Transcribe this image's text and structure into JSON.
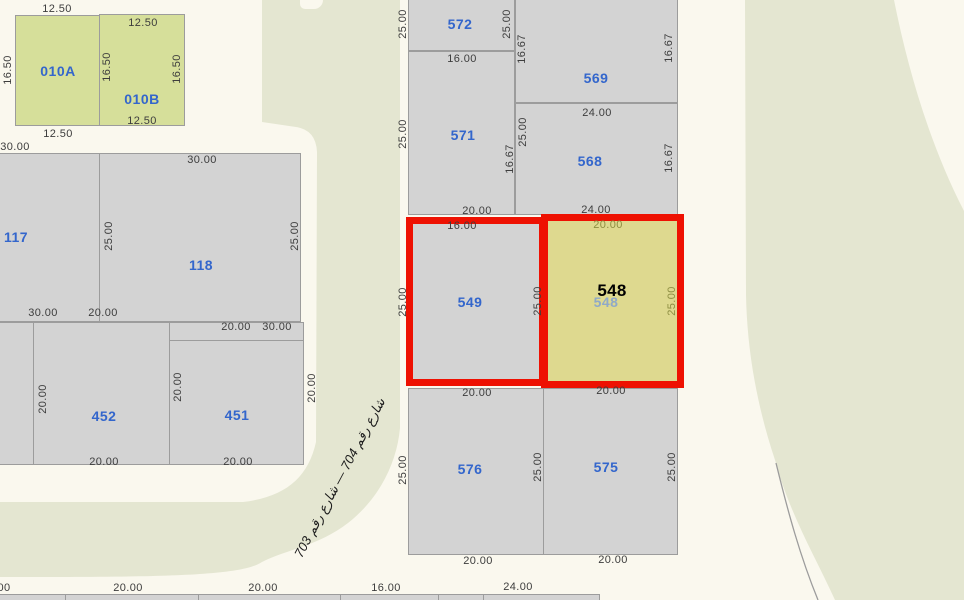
{
  "colors": {
    "background": "#faf8ee",
    "road_green": "#e4e6d1",
    "parcel_gray": "#d3d3d3",
    "parcel_green": "#d6df9a",
    "highlight_yellow": "#ded98f",
    "highlight_red": "#ee1102",
    "parcel_label_blue": "#3366cc",
    "dimension_text": "#3d3d3d",
    "boundary_gray": "#9c9c9c"
  },
  "road": {
    "name_label": "شارع رقم 704 — شارع رقم 703"
  },
  "selected_parcel": {
    "number": "548"
  },
  "parcels": [
    {
      "id": "010A",
      "x": 15,
      "y": 15,
      "w": 85,
      "h": 111,
      "fill": "green"
    },
    {
      "id": "010B",
      "x": 99,
      "y": 14,
      "w": 86,
      "h": 112,
      "fill": "green"
    },
    {
      "id": "117",
      "x": -8,
      "y": 153,
      "w": 108,
      "h": 169,
      "fill": "gray"
    },
    {
      "id": "118",
      "x": 99,
      "y": 153,
      "w": 202,
      "h": 169,
      "fill": "gray"
    },
    {
      "id": "left-sliver",
      "x": -8,
      "y": 322,
      "w": 42,
      "h": 143,
      "fill": "gray"
    },
    {
      "id": "452",
      "x": 33,
      "y": 322,
      "w": 137,
      "h": 143,
      "fill": "gray"
    },
    {
      "id": "451",
      "x": 169,
      "y": 322,
      "w": 135,
      "h": 143,
      "fill": "gray"
    },
    {
      "id": "572",
      "x": 408,
      "y": -2,
      "w": 107,
      "h": 53,
      "fill": "gray"
    },
    {
      "id": "571",
      "x": 408,
      "y": 51,
      "w": 107,
      "h": 164,
      "fill": "gray"
    },
    {
      "id": "569",
      "x": 515,
      "y": -2,
      "w": 163,
      "h": 105,
      "fill": "gray"
    },
    {
      "id": "568",
      "x": 515,
      "y": 103,
      "w": 163,
      "h": 112,
      "fill": "gray"
    },
    {
      "id": "576",
      "x": 408,
      "y": 388,
      "w": 136,
      "h": 167,
      "fill": "gray"
    },
    {
      "id": "575",
      "x": 543,
      "y": 388,
      "w": 135,
      "h": 167,
      "fill": "gray"
    },
    {
      "id": "bottom-strip",
      "x": -2,
      "y": 594,
      "w": 602,
      "h": 10,
      "fill": "gray"
    },
    {
      "id": "549",
      "x": 406,
      "y": 217,
      "w": 140,
      "h": 169,
      "fill": "gray",
      "highlight": true
    },
    {
      "id": "548",
      "x": 541,
      "y": 214,
      "w": 143,
      "h": 174,
      "fill": "yellow",
      "highlight": true
    }
  ],
  "lines": [
    {
      "x": 169,
      "y": 340,
      "w": 135,
      "h": 1
    },
    {
      "x": 65,
      "y": 594,
      "w": 1,
      "h": 7
    },
    {
      "x": 198,
      "y": 594,
      "w": 1,
      "h": 7
    },
    {
      "x": 340,
      "y": 594,
      "w": 1,
      "h": 7
    },
    {
      "x": 438,
      "y": 594,
      "w": 1,
      "h": 7
    },
    {
      "x": 483,
      "y": 594,
      "w": 1,
      "h": 7
    }
  ],
  "labels": [
    {
      "t": "12.50",
      "x": 57,
      "y": 9,
      "cls": "dim"
    },
    {
      "t": "12.50",
      "x": 143,
      "y": 23,
      "cls": "dim"
    },
    {
      "t": "16.50",
      "x": 8,
      "y": 70,
      "cls": "dim",
      "r": -90
    },
    {
      "t": "16.50",
      "x": 107,
      "y": 67,
      "cls": "dim",
      "r": -90
    },
    {
      "t": "16.50",
      "x": 177,
      "y": 69,
      "cls": "dim",
      "r": -90
    },
    {
      "t": "12.50",
      "x": 142,
      "y": 121,
      "cls": "dim"
    },
    {
      "t": "12.50",
      "x": 58,
      "y": 134,
      "cls": "dim"
    },
    {
      "t": "010A",
      "x": 58,
      "y": 71,
      "cls": "parcel-no",
      "name": "parcel-label-010A"
    },
    {
      "t": "010B",
      "x": 142,
      "y": 99,
      "cls": "parcel-no",
      "name": "parcel-label-010B"
    },
    {
      "t": "30.00",
      "x": 15,
      "y": 147,
      "cls": "dim"
    },
    {
      "t": "30.00",
      "x": 202,
      "y": 160,
      "cls": "dim"
    },
    {
      "t": "25.00",
      "x": 109,
      "y": 236,
      "cls": "dim",
      "r": -90
    },
    {
      "t": "25.00",
      "x": 295,
      "y": 236,
      "cls": "dim",
      "r": -90
    },
    {
      "t": "117",
      "x": 16,
      "y": 237,
      "cls": "parcel-no",
      "name": "parcel-label-117"
    },
    {
      "t": "118",
      "x": 201,
      "y": 265,
      "cls": "parcel-no",
      "name": "parcel-label-118"
    },
    {
      "t": "30.00",
      "x": 43,
      "y": 313,
      "cls": "dim"
    },
    {
      "t": "20.00",
      "x": 103,
      "y": 313,
      "cls": "dim"
    },
    {
      "t": "20.00",
      "x": 236,
      "y": 327,
      "cls": "dim"
    },
    {
      "t": "30.00",
      "x": 277,
      "y": 327,
      "cls": "dim"
    },
    {
      "t": "20.00",
      "x": 43,
      "y": 399,
      "cls": "dim",
      "r": -90
    },
    {
      "t": "20.00",
      "x": 178,
      "y": 387,
      "cls": "dim",
      "r": -90
    },
    {
      "t": "20.00",
      "x": 312,
      "y": 388,
      "cls": "dim",
      "r": -90
    },
    {
      "t": "452",
      "x": 104,
      "y": 416,
      "cls": "parcel-no",
      "name": "parcel-label-452"
    },
    {
      "t": "451",
      "x": 237,
      "y": 415,
      "cls": "parcel-no",
      "name": "parcel-label-451"
    },
    {
      "t": "20.00",
      "x": 104,
      "y": 462,
      "cls": "dim"
    },
    {
      "t": "20.00",
      "x": 238,
      "y": 462,
      "cls": "dim"
    },
    {
      "t": "25.00",
      "x": 403,
      "y": 24,
      "cls": "dim",
      "r": -90
    },
    {
      "t": "572",
      "x": 460,
      "y": 24,
      "cls": "parcel-no",
      "name": "parcel-label-572"
    },
    {
      "t": "25.00",
      "x": 507,
      "y": 24,
      "cls": "dim",
      "r": -90
    },
    {
      "t": "16.00",
      "x": 462,
      "y": 59,
      "cls": "dim"
    },
    {
      "t": "16.67",
      "x": 522,
      "y": 49,
      "cls": "dim",
      "r": -90
    },
    {
      "t": "569",
      "x": 596,
      "y": 78,
      "cls": "parcel-no",
      "name": "parcel-label-569"
    },
    {
      "t": "16.67",
      "x": 669,
      "y": 48,
      "cls": "dim",
      "r": -90
    },
    {
      "t": "25.00",
      "x": 403,
      "y": 134,
      "cls": "dim",
      "r": -90
    },
    {
      "t": "571",
      "x": 463,
      "y": 135,
      "cls": "parcel-no",
      "name": "parcel-label-571"
    },
    {
      "t": "16.67",
      "x": 510,
      "y": 159,
      "cls": "dim",
      "r": -90
    },
    {
      "t": "24.00",
      "x": 597,
      "y": 113,
      "cls": "dim"
    },
    {
      "t": "25.00",
      "x": 523,
      "y": 132,
      "cls": "dim",
      "r": -90
    },
    {
      "t": "568",
      "x": 590,
      "y": 161,
      "cls": "parcel-no",
      "name": "parcel-label-568"
    },
    {
      "t": "16.67",
      "x": 669,
      "y": 158,
      "cls": "dim",
      "r": -90
    },
    {
      "t": "20.00",
      "x": 477,
      "y": 211,
      "cls": "dim"
    },
    {
      "t": "24.00",
      "x": 596,
      "y": 210,
      "cls": "dim"
    },
    {
      "t": "16.00",
      "x": 462,
      "y": 226,
      "cls": "dim"
    },
    {
      "t": "20.00",
      "x": 608,
      "y": 225,
      "cls": "dim-olive"
    },
    {
      "t": "25.00",
      "x": 403,
      "y": 302,
      "cls": "dim",
      "r": -90
    },
    {
      "t": "549",
      "x": 470,
      "y": 302,
      "cls": "parcel-no",
      "name": "parcel-label-549"
    },
    {
      "t": "25.00",
      "x": 538,
      "y": 301,
      "cls": "dim",
      "r": -90
    },
    {
      "t": "548",
      "x": 606,
      "y": 302,
      "cls": "parcel-no parcel-no-faded",
      "name": "parcel-label-548"
    },
    {
      "t": "548",
      "x": 612,
      "y": 291,
      "cls": "parcel-no-selected",
      "name": "selected-parcel-label-548"
    },
    {
      "t": "25.00",
      "x": 672,
      "y": 301,
      "cls": "dim-olive",
      "r": -90
    },
    {
      "t": "20.00",
      "x": 477,
      "y": 393,
      "cls": "dim"
    },
    {
      "t": "20.00",
      "x": 611,
      "y": 391,
      "cls": "dim"
    },
    {
      "t": "25.00",
      "x": 403,
      "y": 470,
      "cls": "dim",
      "r": -90
    },
    {
      "t": "576",
      "x": 470,
      "y": 469,
      "cls": "parcel-no",
      "name": "parcel-label-576"
    },
    {
      "t": "25.00",
      "x": 538,
      "y": 467,
      "cls": "dim",
      "r": -90
    },
    {
      "t": "575",
      "x": 606,
      "y": 467,
      "cls": "parcel-no",
      "name": "parcel-label-575"
    },
    {
      "t": "25.00",
      "x": 672,
      "y": 467,
      "cls": "dim",
      "r": -90
    },
    {
      "t": "20.00",
      "x": 478,
      "y": 561,
      "cls": "dim"
    },
    {
      "t": "20.00",
      "x": 613,
      "y": 560,
      "cls": "dim"
    },
    {
      "t": "00",
      "x": 4,
      "y": 588,
      "cls": "dim"
    },
    {
      "t": "20.00",
      "x": 128,
      "y": 588,
      "cls": "dim"
    },
    {
      "t": "20.00",
      "x": 263,
      "y": 588,
      "cls": "dim"
    },
    {
      "t": "16.00",
      "x": 386,
      "y": 588,
      "cls": "dim"
    },
    {
      "t": "24.00",
      "x": 518,
      "y": 587,
      "cls": "dim"
    },
    {
      "t": "شارع رقم 704 — شارع رقم 703",
      "x": 340,
      "y": 478,
      "cls": "road-name",
      "r": -62,
      "name": "road-name-label"
    }
  ]
}
